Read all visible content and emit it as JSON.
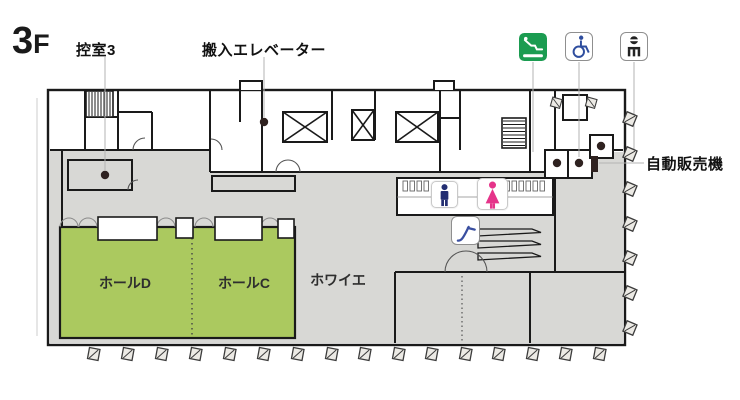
{
  "floor": {
    "number": "3",
    "suffix": "F"
  },
  "labels": {
    "dressing_room": "控室3",
    "loading_elevator": "搬入エレベーター",
    "vending_machine": "自動販売機",
    "hall_d": "ホールD",
    "hall_c": "ホールC",
    "foyer": "ホワイエ"
  },
  "icons": {
    "escalator": {
      "name": "escalator",
      "bg": "#1b9c51",
      "fg": "#ffffff"
    },
    "accessible": {
      "name": "wheelchair-accessible",
      "color": "#2e4d9e"
    },
    "service": {
      "name": "vending-corner",
      "color": "#222222"
    },
    "male": {
      "name": "mens-restroom",
      "color": "#232e72"
    },
    "female": {
      "name": "womens-restroom",
      "color": "#e5348a"
    },
    "escalator_small": {
      "name": "escalator-down",
      "color": "#3a4fa0"
    }
  },
  "colors": {
    "hall_green": "#abc95f",
    "floor_gray": "#d8d8d5",
    "wall": "#1a1a1a",
    "marker": "#2f2220",
    "leader": "#b3b3b3"
  }
}
